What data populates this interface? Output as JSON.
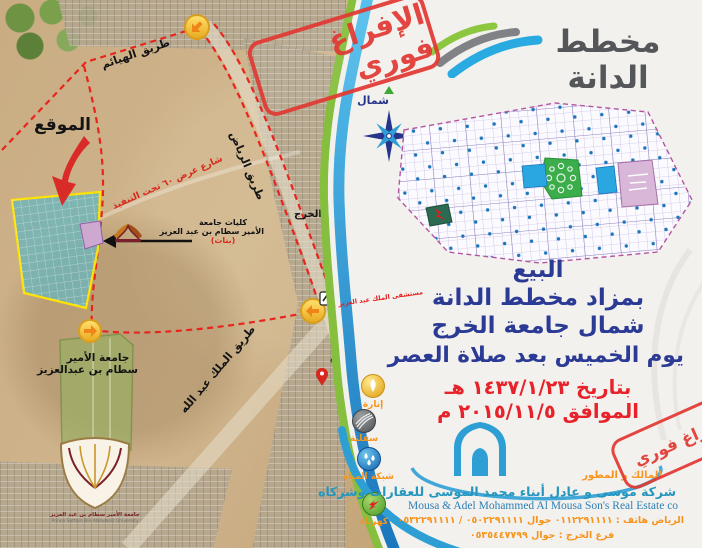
{
  "brand": {
    "name": "مخطط الدانة"
  },
  "stamp": {
    "text": "الإفراغ فوري"
  },
  "compass": {
    "north": "شمال"
  },
  "map": {
    "location": "الموقع",
    "road_hayathem": "طريق الهيائم",
    "road_riyadh": "طريق الرياض",
    "road_king_abdullah": "طريق الملك عبد الله",
    "street_60": "شارع عرض ٦٠ تحت التنفيذ",
    "kharj_tower": "برج الخرج",
    "colleges_l1": "كليات جامعة",
    "colleges_l2": "الأمير سطام بن عبد العزيز",
    "colleges_l3": "(بنات)",
    "university_l1": "جامعة الأمير",
    "university_l2": "سطام بن عبدالعزيز",
    "crest_caption_ar": "جامعة الأمير سطام بن عبد العزيز",
    "crest_caption_en": "Prince Sattam Bin Abdulaziz University",
    "hospital": "مستشفى الملك عبد العزيز",
    "mosque": "جامع"
  },
  "announcement": {
    "l1": "البيع",
    "l2": "بمزاد مخطط الدانة",
    "l3": "شمال جامعة الخرج",
    "l4": "يوم الخميس بعد صلاة العصر",
    "hijri": "بتاريخ ١٤٣٧/١/٢٣ هـ",
    "gregorian": "الموافق ٢٠١٥/١١/٥ م"
  },
  "services": [
    {
      "label": "إنارة"
    },
    {
      "label": "سفلتة"
    },
    {
      "label": "شبكة المياه"
    },
    {
      "label": "كهرباء"
    }
  ],
  "company": {
    "role": "المالك و المطور",
    "name_ar": "شركة موسى و عادل أبناء محمد الموسى للعقارات وشركاه",
    "name_en": "Mousa & Adel Mohammed Al Mousa Son's Real Estate co",
    "phone_riyadh": "الرياض هاتف : ٠١١٢٢٩١١١١ جوال ٠٥٠٢٢٩١١١١ / ٠٥٣٢٢٩١١١١",
    "phone_kharj": "فرع الخرج : جوال ٠٥٣٥٤٤٧٧٩٩"
  },
  "colors": {
    "headline_blue": "#2b3a95",
    "accent_red": "#e8222a",
    "accent_orange": "#f7941d",
    "brand_blue": "#29abe2",
    "brand_green": "#8dc63f"
  }
}
